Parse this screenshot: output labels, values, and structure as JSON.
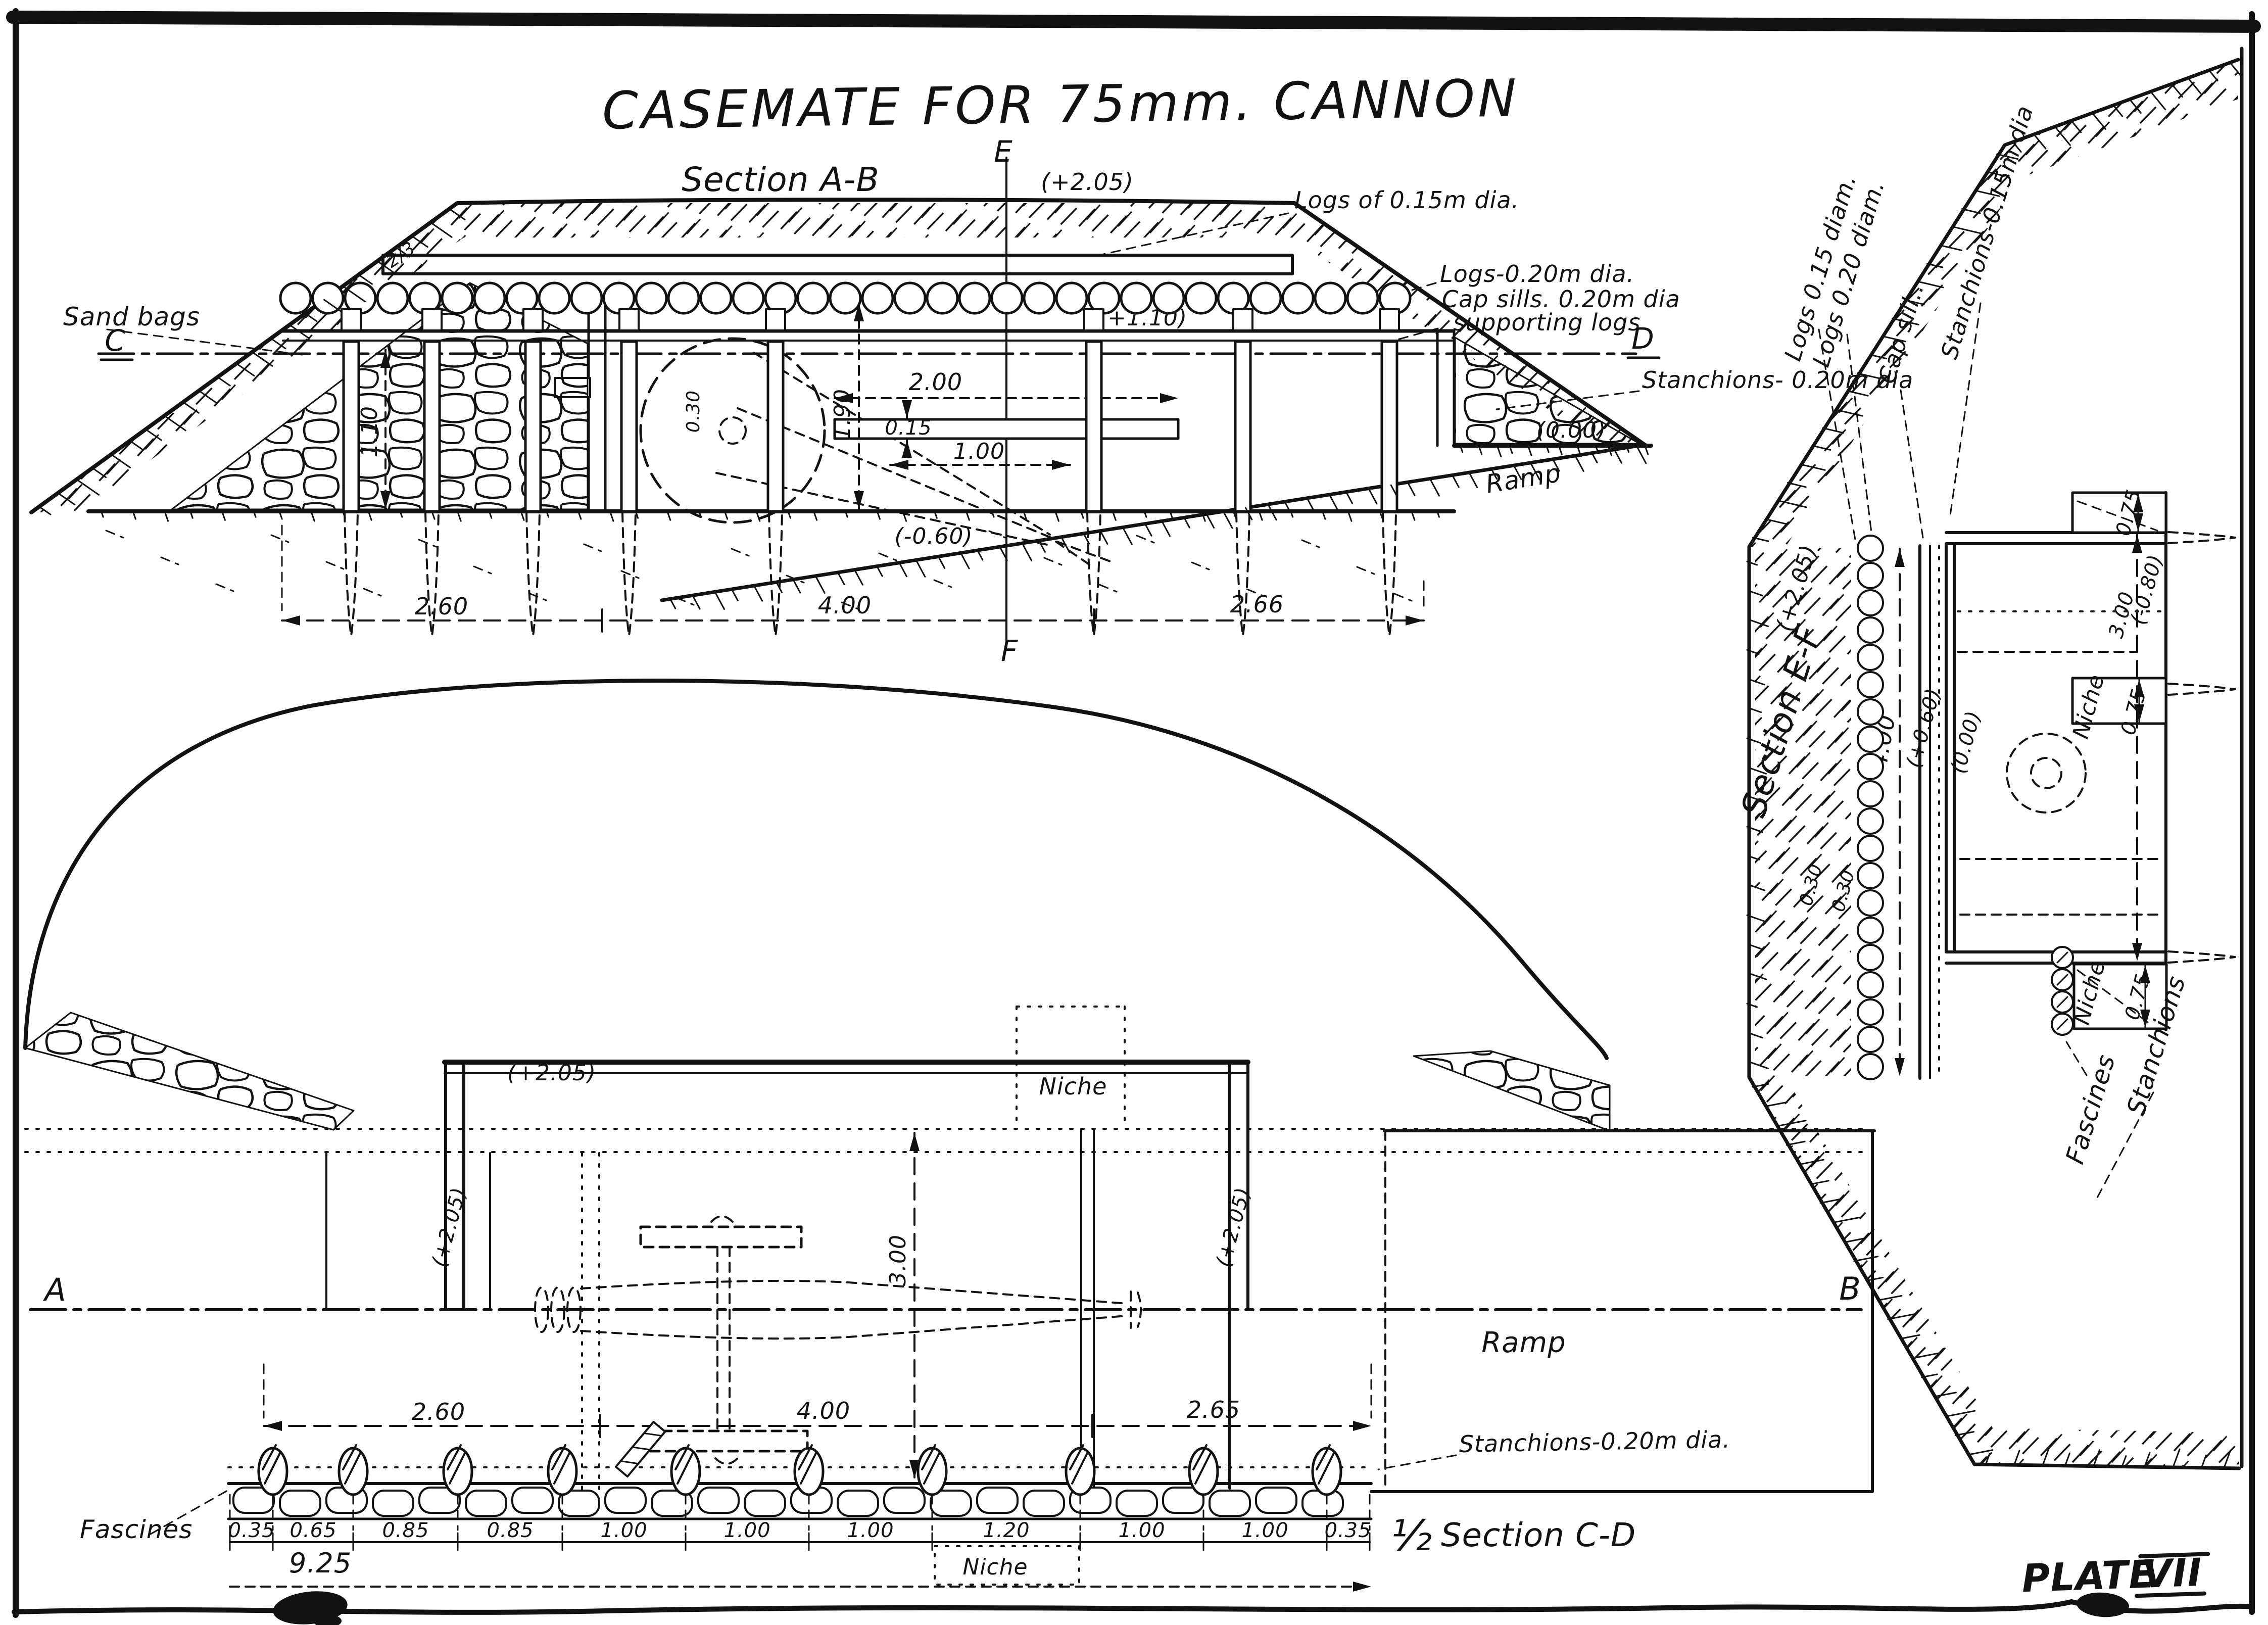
{
  "plate": {
    "title": "CASEMATE FOR 75mm. CANNON",
    "plate_word": "PLATE",
    "plate_numeral": "VII"
  },
  "section_ab": {
    "title": "Section A-B",
    "points": {
      "c": "C",
      "d": "D",
      "e": "E",
      "f": "F"
    },
    "labels": {
      "sand_bags": "Sand bags",
      "slope": "2/3",
      "logs_roof": "Logs of 0.15m dia.",
      "logs": "Logs-0.20m dia.",
      "cap_sills_1": "Cap sills. 0.20m dia",
      "cap_sills_2": "supporting logs",
      "stanchions": "Stanchions- 0.20m dia",
      "ramp": "Ramp"
    },
    "elevations": {
      "crest": "(+2.05)",
      "sill": "(+1.10)",
      "ground": "(0.00)",
      "floor": "(-0.60)"
    },
    "dims": {
      "left": "2.60",
      "middle": "4.00",
      "right": "2.66",
      "wall_height": "1.10",
      "interior": "1.90",
      "span": "2.00",
      "plank": "0.15",
      "clear": "1.00",
      "wall_thickness": "0.30"
    }
  },
  "section_ef": {
    "title": "Section E-F",
    "labels": {
      "logs_015": "Logs 0.15 diam.",
      "logs_020": "Logs 0.20 diam.",
      "cap_sill": "Cap sill..",
      "stanchions_015": "Stanchions-0.15m dia",
      "niche_mid": "Niche",
      "niche_lower": "Niche",
      "fascines": "Fascines",
      "stanchions": "Stanchions"
    },
    "elevations": {
      "crest": "(+2.05)",
      "berm": "(+0.60)",
      "ground": "(0.00)",
      "floor": "(-0.80)"
    },
    "dims": {
      "cover": "4.00",
      "layer1": "0.30",
      "layer2": "0.30",
      "niche_top": "0.75",
      "width": "3.00",
      "niche_mid": "0.75",
      "niche_lower": "0.75"
    }
  },
  "plan": {
    "points": {
      "a": "A",
      "b": "B"
    },
    "labels": {
      "niche_top": "Niche",
      "niche_bottom": "Niche",
      "ramp": "Ramp",
      "stanchions": "Stanchions-0.20m dia.",
      "fascines": "Fascines"
    },
    "elevations": {
      "interior": "(+2.05)",
      "wall_left": "(+2.05)",
      "wall_right": "(+2.05)"
    },
    "dims": {
      "left": "2.60",
      "middle": "4.00",
      "right": "2.65",
      "depth": "3.00",
      "total": "9.25",
      "spacing": [
        "0.35",
        "0.65",
        "0.85",
        "0.85",
        "1.00",
        "1.00",
        "1.00",
        "1.20",
        "1.00",
        "1.00",
        "0.35"
      ]
    },
    "caption": {
      "half": "½",
      "name": "Section C-D"
    }
  }
}
